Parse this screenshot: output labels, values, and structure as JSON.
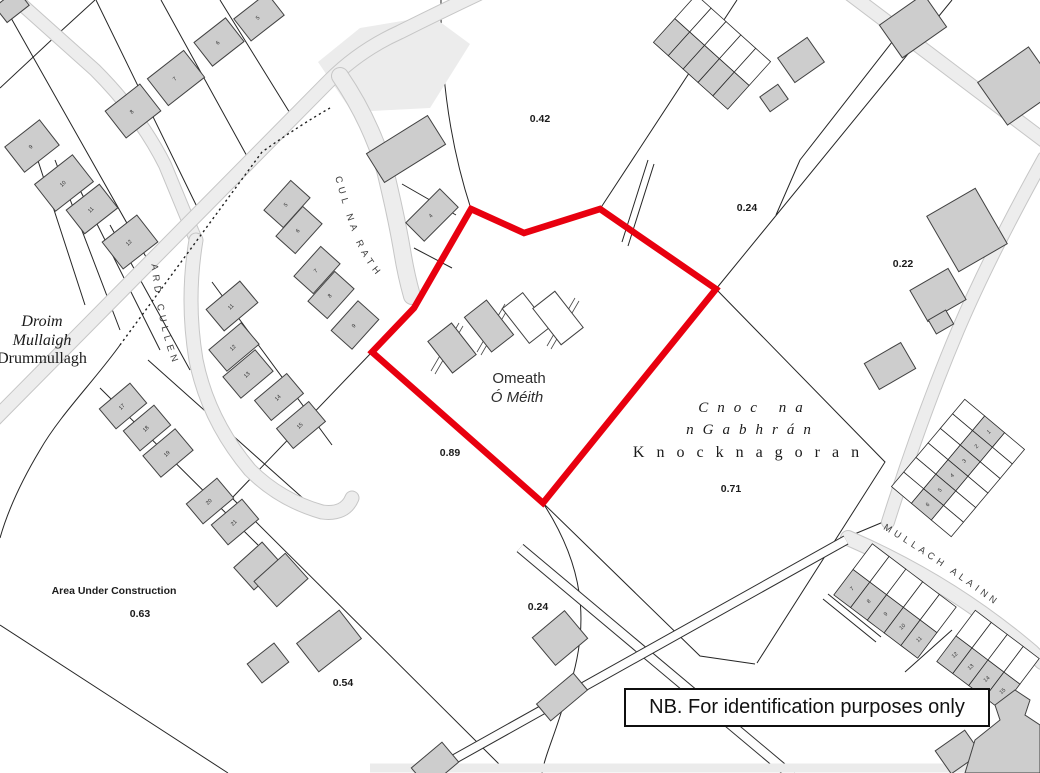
{
  "note_box": {
    "text": "NB. For identification purposes only"
  },
  "map": {
    "colors": {
      "background": "#ffffff",
      "boundary_red": "#e8000f",
      "building_fill": "#cdcdcd",
      "building_stroke": "#414141",
      "road_fill": "#ededed",
      "road_edge": "#c6c6c6",
      "parcel_line": "#262626"
    },
    "boundary_points": "471,209 524,233 600,209 716,289 543,503 372,352 414,308",
    "labels": [
      {
        "t": "0.42",
        "x": 540,
        "y": 122,
        "s": 10.5,
        "b": 1,
        "n": "area-value-042"
      },
      {
        "t": "0.24",
        "x": 747,
        "y": 211,
        "s": 10.5,
        "b": 1,
        "n": "area-value-024-upper"
      },
      {
        "t": "0.22",
        "x": 903,
        "y": 267,
        "s": 10.5,
        "b": 1,
        "n": "area-value-022"
      },
      {
        "t": "0.89",
        "x": 450,
        "y": 456,
        "s": 10.5,
        "b": 1,
        "n": "area-value-089"
      },
      {
        "t": "0.71",
        "x": 731,
        "y": 492,
        "s": 10.5,
        "b": 1,
        "n": "area-value-071"
      },
      {
        "t": "0.24",
        "x": 538,
        "y": 610,
        "s": 10.5,
        "b": 1,
        "n": "area-value-024-lower"
      },
      {
        "t": "0.63",
        "x": 140,
        "y": 617,
        "s": 10.5,
        "b": 1,
        "n": "area-value-063"
      },
      {
        "t": "0.54",
        "x": 343,
        "y": 686,
        "s": 10.5,
        "b": 1,
        "n": "area-value-054"
      },
      {
        "t": "Area Under Construction",
        "x": 114,
        "y": 594,
        "s": 10.5,
        "b": 1,
        "n": "area-under-construction-label"
      },
      {
        "t": "Omeath",
        "x": 519,
        "y": 383,
        "s": 15,
        "c": "#2e2e2e",
        "n": "townland-label-omeath-en"
      },
      {
        "t": "Ó Méith",
        "x": 517,
        "y": 402,
        "s": 15,
        "i": 1,
        "c": "#2e2e2e",
        "n": "townland-label-omeath-ga"
      },
      {
        "t": "Droim",
        "x": 42,
        "y": 326,
        "s": 16,
        "f": "serif",
        "i": 1,
        "n": "townland-label-drummullagh-ga-1"
      },
      {
        "t": "Mullaigh",
        "x": 42,
        "y": 345,
        "s": 16,
        "f": "serif",
        "i": 1,
        "n": "townland-label-drummullagh-ga-2"
      },
      {
        "t": "Drummullagh",
        "x": 42,
        "y": 363,
        "s": 16,
        "f": "serif",
        "n": "townland-label-drummullagh-en"
      },
      {
        "t": "Cnoc  na",
        "x": 755,
        "y": 412,
        "s": 15,
        "f": "serif",
        "i": 1,
        "ls": 9,
        "n": "townland-label-knocknagoran-ga-1"
      },
      {
        "t": "nGabhrán",
        "x": 753,
        "y": 434,
        "s": 15,
        "f": "serif",
        "i": 1,
        "ls": 9,
        "n": "townland-label-knocknagoran-ga-2"
      },
      {
        "t": "Knocknagoran",
        "x": 752,
        "y": 457,
        "s": 16,
        "f": "serif",
        "ls": 12,
        "n": "townland-label-knocknagoran-en"
      }
    ],
    "road_labels": [
      {
        "t": "CUL NA RATH",
        "path": "rd-cul",
        "s": 9.5,
        "ls": 4.5,
        "off": 4
      },
      {
        "t": "ARD CULLEN",
        "path": "rd-ard",
        "s": 9.5,
        "ls": 4.5,
        "off": 4
      },
      {
        "t": "MULLACH ALAINN",
        "path": "rd-mul",
        "s": 9.5,
        "ls": 4,
        "off": 6
      }
    ],
    "house_numbers": [
      [
        "5",
        259,
        19,
        -45
      ],
      [
        "6",
        219,
        44,
        -45
      ],
      [
        "7",
        176,
        80,
        -45
      ],
      [
        "8",
        133,
        113,
        -45
      ],
      [
        "9",
        32,
        148,
        -45
      ],
      [
        "10",
        64,
        185,
        -45
      ],
      [
        "11",
        92,
        211,
        -45
      ],
      [
        "12",
        130,
        244,
        -45
      ],
      [
        "5",
        287,
        206,
        -45
      ],
      [
        "6",
        299,
        232,
        -45
      ],
      [
        "7",
        317,
        272,
        -45
      ],
      [
        "8",
        331,
        297,
        -45
      ],
      [
        "9",
        355,
        327,
        -45
      ],
      [
        "4",
        432,
        217,
        -45
      ],
      [
        "11",
        232,
        308,
        -45
      ],
      [
        "12",
        234,
        349,
        -45
      ],
      [
        "13",
        248,
        376,
        -45
      ],
      [
        "14",
        279,
        399,
        -45
      ],
      [
        "15",
        301,
        427,
        -45
      ],
      [
        "17",
        123,
        408,
        -45
      ],
      [
        "18",
        147,
        430,
        -45
      ],
      [
        "19",
        168,
        455,
        -45
      ],
      [
        "20",
        210,
        503,
        -45
      ],
      [
        "21",
        235,
        524,
        -45
      ]
    ],
    "buildings": [
      [
        12,
        6,
        28,
        20,
        -38,
        "g"
      ],
      [
        259,
        17,
        42,
        28,
        -38,
        "g"
      ],
      [
        219,
        42,
        40,
        30,
        -38,
        "g"
      ],
      [
        176,
        78,
        46,
        34,
        -38,
        "g"
      ],
      [
        133,
        111,
        44,
        34,
        -38,
        "g"
      ],
      [
        32,
        146,
        44,
        32,
        -38,
        "g"
      ],
      [
        64,
        183,
        48,
        34,
        -38,
        "g"
      ],
      [
        92,
        209,
        42,
        30,
        -38,
        "g"
      ],
      [
        130,
        242,
        44,
        34,
        -38,
        "g"
      ],
      [
        287,
        204,
        40,
        26,
        -48,
        "g"
      ],
      [
        299,
        230,
        40,
        26,
        -48,
        "g"
      ],
      [
        317,
        270,
        40,
        26,
        -48,
        "g"
      ],
      [
        331,
        295,
        40,
        26,
        -48,
        "g"
      ],
      [
        355,
        325,
        40,
        28,
        -48,
        "g"
      ],
      [
        406,
        149,
        72,
        34,
        -32,
        "g"
      ],
      [
        432,
        215,
        48,
        26,
        -45,
        "g"
      ],
      [
        232,
        306,
        44,
        28,
        -40,
        "g"
      ],
      [
        234,
        347,
        42,
        28,
        -40,
        "g"
      ],
      [
        248,
        374,
        42,
        28,
        -40,
        "g"
      ],
      [
        279,
        397,
        42,
        26,
        -40,
        "g"
      ],
      [
        301,
        425,
        42,
        26,
        -40,
        "g"
      ],
      [
        123,
        406,
        40,
        26,
        -40,
        "g"
      ],
      [
        147,
        428,
        40,
        26,
        -40,
        "g"
      ],
      [
        168,
        453,
        42,
        28,
        -40,
        "g"
      ],
      [
        210,
        501,
        40,
        26,
        -40,
        "g"
      ],
      [
        235,
        522,
        40,
        26,
        -40,
        "g"
      ],
      [
        452,
        348,
        30,
        40,
        -38,
        "g"
      ],
      [
        489,
        326,
        28,
        44,
        -38,
        "g"
      ],
      [
        526,
        318,
        26,
        44,
        -38,
        "w"
      ],
      [
        558,
        318,
        28,
        46,
        -38,
        "w"
      ],
      [
        913,
        26,
        54,
        40,
        -35,
        "g"
      ],
      [
        1018,
        86,
        62,
        52,
        -35,
        "g"
      ],
      [
        801,
        60,
        36,
        30,
        -35,
        "g"
      ],
      [
        774,
        98,
        22,
        18,
        -35,
        "g"
      ],
      [
        967,
        230,
        56,
        64,
        -30,
        "g"
      ],
      [
        938,
        295,
        44,
        36,
        -30,
        "g"
      ],
      [
        941,
        322,
        20,
        16,
        -30,
        "g"
      ],
      [
        890,
        366,
        42,
        30,
        -30,
        "g"
      ],
      [
        560,
        638,
        42,
        36,
        -40,
        "g"
      ],
      [
        562,
        697,
        48,
        22,
        -40,
        "g"
      ],
      [
        258,
        566,
        38,
        30,
        -42,
        "g"
      ],
      [
        281,
        580,
        42,
        34,
        -42,
        "g"
      ],
      [
        329,
        641,
        54,
        36,
        -38,
        "g"
      ],
      [
        268,
        663,
        34,
        24,
        -38,
        "g"
      ],
      [
        435,
        765,
        40,
        26,
        -40,
        "g"
      ],
      [
        958,
        752,
        36,
        28,
        -35,
        "g"
      ]
    ],
    "terraces": [
      {
        "cx": 958,
        "cy": 468,
        "rot": 40,
        "cw": 26,
        "ch": 19,
        "cols": 3,
        "rows": 6,
        "gray": 1,
        "nums": [
          "1",
          "2",
          "3",
          "4",
          "5",
          "6"
        ]
      },
      {
        "cx": 895,
        "cy": 601,
        "rot": -53,
        "cw": 32,
        "ch": 21,
        "cols": 2,
        "rows": 5,
        "gray": 0,
        "nums": [
          "7",
          "8",
          "9",
          "10",
          "11"
        ]
      },
      {
        "cx": 988,
        "cy": 660,
        "rot": -53,
        "cw": 32,
        "ch": 20,
        "cols": 2,
        "rows": 4,
        "gray": 0,
        "nums": [
          "12",
          "13",
          "14",
          "15"
        ]
      },
      {
        "cx": 712,
        "cy": 52,
        "rot": -48,
        "cw": 32,
        "ch": 20,
        "cols": 2,
        "rows": 5,
        "gray": 0,
        "nums": []
      }
    ]
  }
}
